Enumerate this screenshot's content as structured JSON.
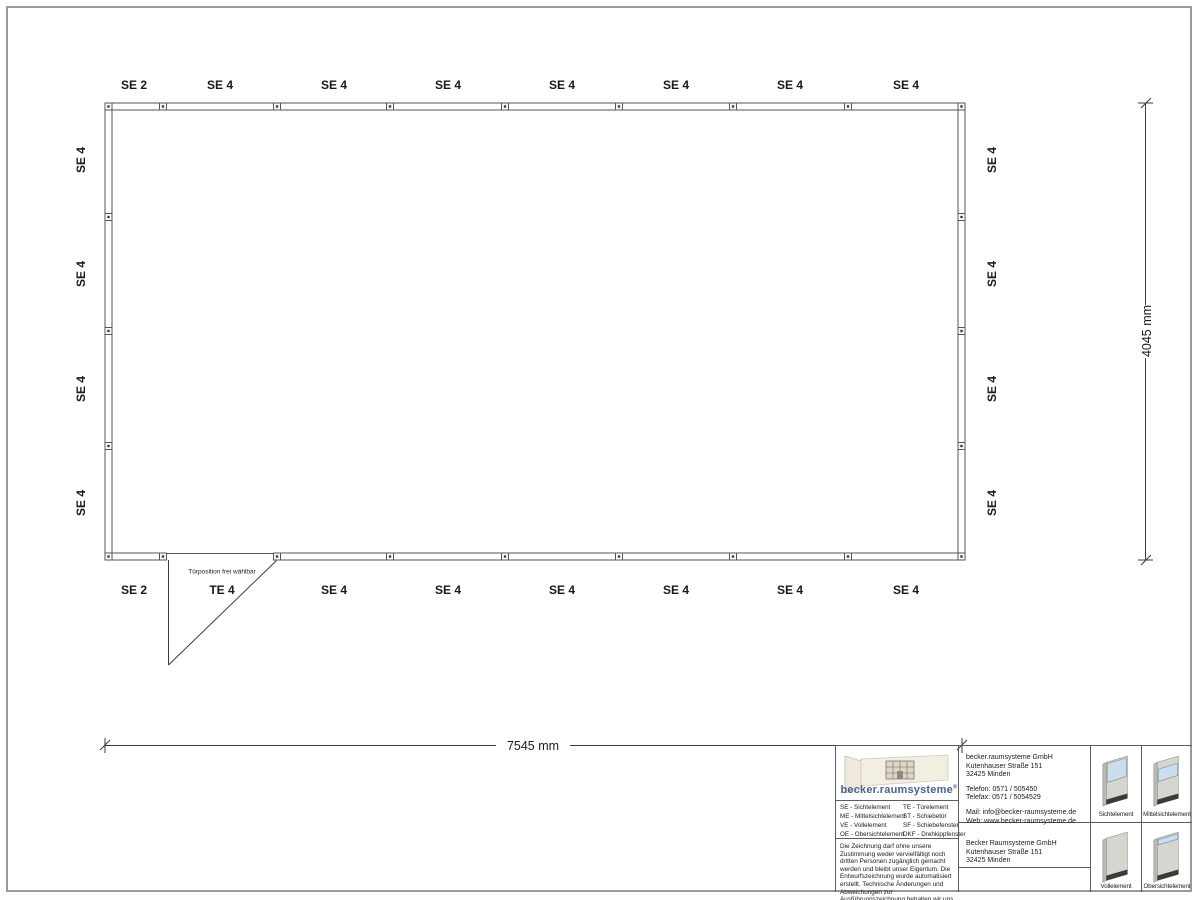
{
  "plan": {
    "top_labels": [
      "SE 2",
      "SE 4",
      "SE 4",
      "SE 4",
      "SE 4",
      "SE 4",
      "SE 4",
      "SE 4"
    ],
    "bottom_labels": [
      "SE 2",
      "TE 4",
      "SE 4",
      "SE 4",
      "SE 4",
      "SE 4",
      "SE 4",
      "SE 4"
    ],
    "left_labels": [
      "SE 4",
      "SE 4",
      "SE 4",
      "SE 4"
    ],
    "right_labels": [
      "SE 4",
      "SE 4",
      "SE 4",
      "SE 4"
    ],
    "door_note": "Türposition frei wählbar"
  },
  "dimensions": {
    "width_label": "7545 mm",
    "height_label": "4045 mm"
  },
  "titleblock": {
    "logo": {
      "text": "becker.raumsysteme",
      "registered": "®",
      "brand_color": "#4a6390"
    },
    "legend": {
      "col1": [
        "SE - Sichtelement",
        "ME - Mittelsichtelement",
        "VE - Vollelement",
        "OE - Obersichtelement"
      ],
      "col2": [
        "TE - Türelement",
        "ST - Schiebetür",
        "SF - Schiebefenster",
        "DKF - Drehkippfenster"
      ]
    },
    "contact": {
      "company": [
        "becker.raumsysteme GmbH",
        "Kutenhauser Straße 151",
        "32425 Minden"
      ],
      "phone": [
        "Telefon: 0571 / 505450",
        "Telefax: 0571 / 5054529"
      ],
      "web": [
        "Mail: info@becker-raumsysteme.de",
        "Web: www.becker-raumsysteme.de"
      ]
    },
    "address": [
      "Becker Raumsysteme GmbH",
      "Kutenhauser Straße 151",
      "32425 Minden"
    ],
    "disclaimer": "Die Zeichnung darf ohne unsere Zustimmung weder vervielfältigt noch dritten Personen zugänglich gemacht werden und bleibt unser Eigentum. Die Entwurfszeichnung wurde automatisiert erstellt. Technische Änderungen und Abweichungen zur Ausführungszeichnung behalten wir uns vor.",
    "tiles": [
      "Sichtelement",
      "Mittelsichtelement",
      "Vollelement",
      "Obersichtelement"
    ],
    "colors": {
      "glass": "#ccdeeb",
      "panel": "#d6d6d1"
    }
  }
}
